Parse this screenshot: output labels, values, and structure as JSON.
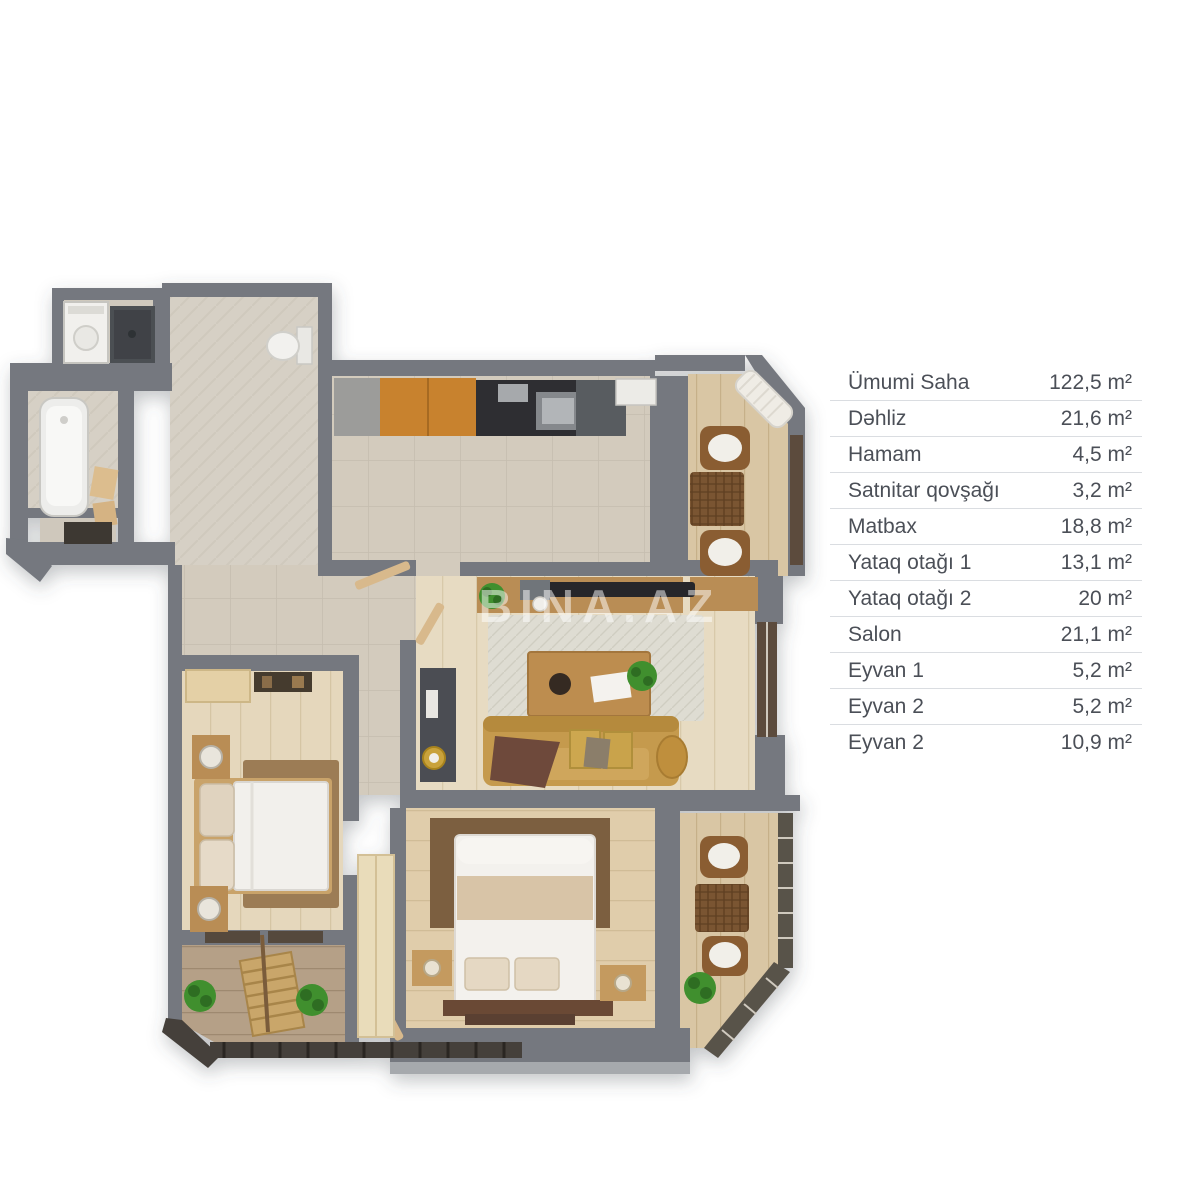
{
  "watermark": {
    "text": "BINA.AZ"
  },
  "legend": {
    "text_color": "#4b4f57",
    "divider_color": "#dadde1",
    "rows": [
      {
        "label": "Ümumi Saha",
        "value": "122,5 m²"
      },
      {
        "label": "Dəhliz",
        "value": "21,6 m²"
      },
      {
        "label": "Hamam",
        "value": "4,5 m²"
      },
      {
        "label": "Satnitar qovşağı",
        "value": "3,2 m²"
      },
      {
        "label": "Matbax",
        "value": "18,8 m²"
      },
      {
        "label": "Yataq otağı 1",
        "value": "13,1 m²"
      },
      {
        "label": "Yataq otağı 2",
        "value": "20 m²"
      },
      {
        "label": "Salon",
        "value": "21,1 m²"
      },
      {
        "label": "Eyvan 1",
        "value": "5,2 m²"
      },
      {
        "label": "Eyvan 2",
        "value": "5,2 m²"
      },
      {
        "label": "Eyvan 2",
        "value": "10,9 m²"
      }
    ]
  },
  "floorplan": {
    "colors": {
      "wall": "#74787f",
      "wall_light": "#a6a9ad",
      "floor_tile": "#d3cbbd",
      "floor_herringbone": "#d6d0c5",
      "floor_wood_salon": "#e7dbc2",
      "floor_wood_bed1": "#e5d7bc",
      "floor_wood_bed2": "#e0cdab",
      "floor_balcony": "#d9c6a4",
      "floor_balcony_dark": "#b5a087",
      "cabinet_orange": "#c8822f",
      "counter_dark": "#2d2e30",
      "wood_furniture": "#b98d55",
      "sofa": "#c59a4e",
      "rug_light": "#dedcd2",
      "rug_brown": "#9c7c55",
      "rug_dark_brown": "#7c5f3f",
      "bedding_white": "#f2f0ec",
      "wicker": "#8a5d33",
      "plant": "#3f8f2f",
      "fixture_white": "#efeeea",
      "window_dark": "#5c4c3d",
      "railing_dark": "#45403a",
      "watermark": "#ffffff"
    }
  }
}
